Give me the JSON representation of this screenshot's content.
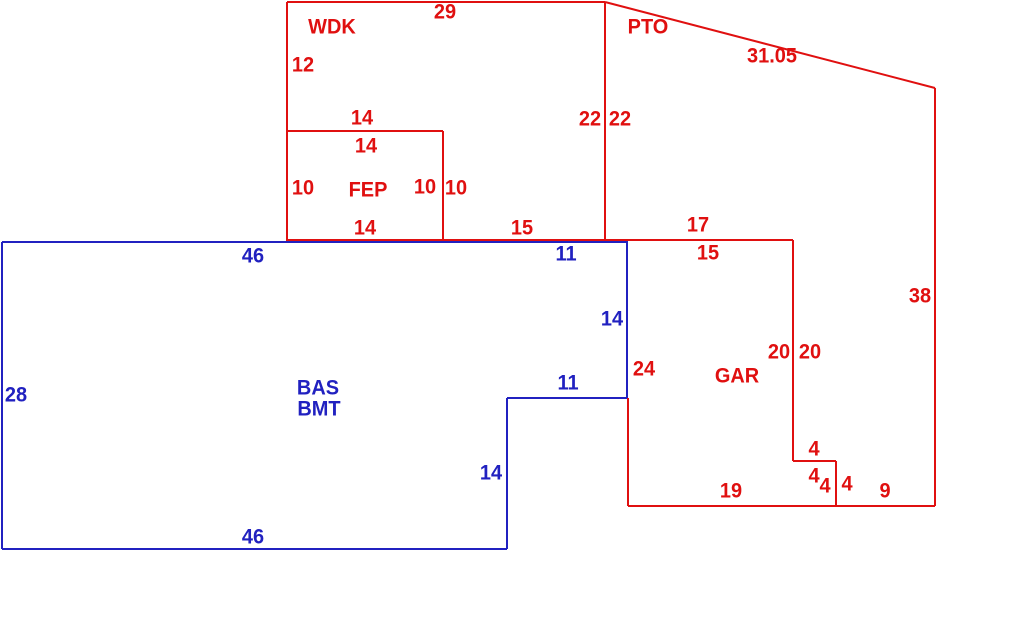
{
  "canvas": {
    "width": 1010,
    "height": 623,
    "background": "#ffffff"
  },
  "colors": {
    "red": "#e01010",
    "blue": "#2121c0"
  },
  "sketch": {
    "description": "Property appraisal floor-plan sketch with red exterior structures (WDK wood deck, PTO patio, FEP enclosed porch, GAR garage) and blue basement outline (BAS BMT)",
    "areas": [
      {
        "code": "WDK",
        "color": "red"
      },
      {
        "code": "PTO",
        "color": "red"
      },
      {
        "code": "FEP",
        "color": "red"
      },
      {
        "code": "GAR",
        "color": "red"
      },
      {
        "code": "BAS BMT",
        "color": "blue"
      }
    ],
    "red_segments": [
      [
        287,
        2,
        605,
        2
      ],
      [
        287,
        2,
        287,
        242
      ],
      [
        605,
        2,
        935,
        88
      ],
      [
        935,
        88,
        935,
        506
      ],
      [
        605,
        2,
        605,
        241
      ],
      [
        287,
        131,
        443,
        131
      ],
      [
        443,
        131,
        443,
        241
      ],
      [
        287,
        240,
        793,
        240
      ],
      [
        793,
        240,
        793,
        461
      ],
      [
        793,
        461,
        836,
        461
      ],
      [
        836,
        461,
        836,
        506
      ],
      [
        628,
        506,
        935,
        506
      ],
      [
        628,
        398,
        628,
        506
      ]
    ],
    "blue_segments": [
      [
        2,
        242,
        628,
        242
      ],
      [
        2,
        242,
        2,
        549
      ],
      [
        2,
        549,
        507,
        549
      ],
      [
        507,
        398,
        507,
        549
      ],
      [
        507,
        398,
        627,
        398
      ],
      [
        627,
        242,
        627,
        398
      ]
    ],
    "labels": [
      {
        "text": "29",
        "x": 445,
        "y": 12,
        "color": "red"
      },
      {
        "text": "WDK",
        "x": 332,
        "y": 27,
        "color": "red"
      },
      {
        "text": "PTO",
        "x": 648,
        "y": 27,
        "color": "red"
      },
      {
        "text": "31.05",
        "x": 772,
        "y": 56,
        "color": "red"
      },
      {
        "text": "12",
        "x": 303,
        "y": 65,
        "color": "red"
      },
      {
        "text": "14",
        "x": 362,
        "y": 118,
        "color": "red"
      },
      {
        "text": "22",
        "x": 590,
        "y": 119,
        "color": "red"
      },
      {
        "text": "22",
        "x": 620,
        "y": 119,
        "color": "red"
      },
      {
        "text": "14",
        "x": 366,
        "y": 146,
        "color": "red"
      },
      {
        "text": "10",
        "x": 303,
        "y": 188,
        "color": "red"
      },
      {
        "text": "FEP",
        "x": 368,
        "y": 190,
        "color": "red"
      },
      {
        "text": "10",
        "x": 425,
        "y": 187,
        "color": "red"
      },
      {
        "text": "10",
        "x": 456,
        "y": 188,
        "color": "red"
      },
      {
        "text": "14",
        "x": 365,
        "y": 228,
        "color": "red"
      },
      {
        "text": "15",
        "x": 522,
        "y": 228,
        "color": "red"
      },
      {
        "text": "17",
        "x": 698,
        "y": 225,
        "color": "red"
      },
      {
        "text": "46",
        "x": 253,
        "y": 256,
        "color": "blue"
      },
      {
        "text": "11",
        "x": 566,
        "y": 254,
        "color": "blue"
      },
      {
        "text": "15",
        "x": 708,
        "y": 253,
        "color": "red"
      },
      {
        "text": "38",
        "x": 920,
        "y": 296,
        "color": "red"
      },
      {
        "text": "14",
        "x": 612,
        "y": 319,
        "color": "blue"
      },
      {
        "text": "20",
        "x": 779,
        "y": 352,
        "color": "red"
      },
      {
        "text": "20",
        "x": 810,
        "y": 352,
        "color": "red"
      },
      {
        "text": "24",
        "x": 644,
        "y": 369,
        "color": "red"
      },
      {
        "text": "GAR",
        "x": 737,
        "y": 376,
        "color": "red"
      },
      {
        "text": "11",
        "x": 568,
        "y": 383,
        "color": "blue"
      },
      {
        "text": "BAS",
        "x": 318,
        "y": 388,
        "color": "blue"
      },
      {
        "text": "28",
        "x": 16,
        "y": 395,
        "color": "blue"
      },
      {
        "text": "BMT",
        "x": 319,
        "y": 409,
        "color": "blue"
      },
      {
        "text": "4",
        "x": 814,
        "y": 449,
        "color": "red"
      },
      {
        "text": "14",
        "x": 491,
        "y": 473,
        "color": "blue"
      },
      {
        "text": "4",
        "x": 814,
        "y": 476,
        "color": "red"
      },
      {
        "text": "4",
        "x": 825,
        "y": 486,
        "color": "red"
      },
      {
        "text": "4",
        "x": 847,
        "y": 484,
        "color": "red"
      },
      {
        "text": "19",
        "x": 731,
        "y": 491,
        "color": "red"
      },
      {
        "text": "9",
        "x": 885,
        "y": 491,
        "color": "red"
      },
      {
        "text": "46",
        "x": 253,
        "y": 537,
        "color": "blue"
      }
    ]
  }
}
